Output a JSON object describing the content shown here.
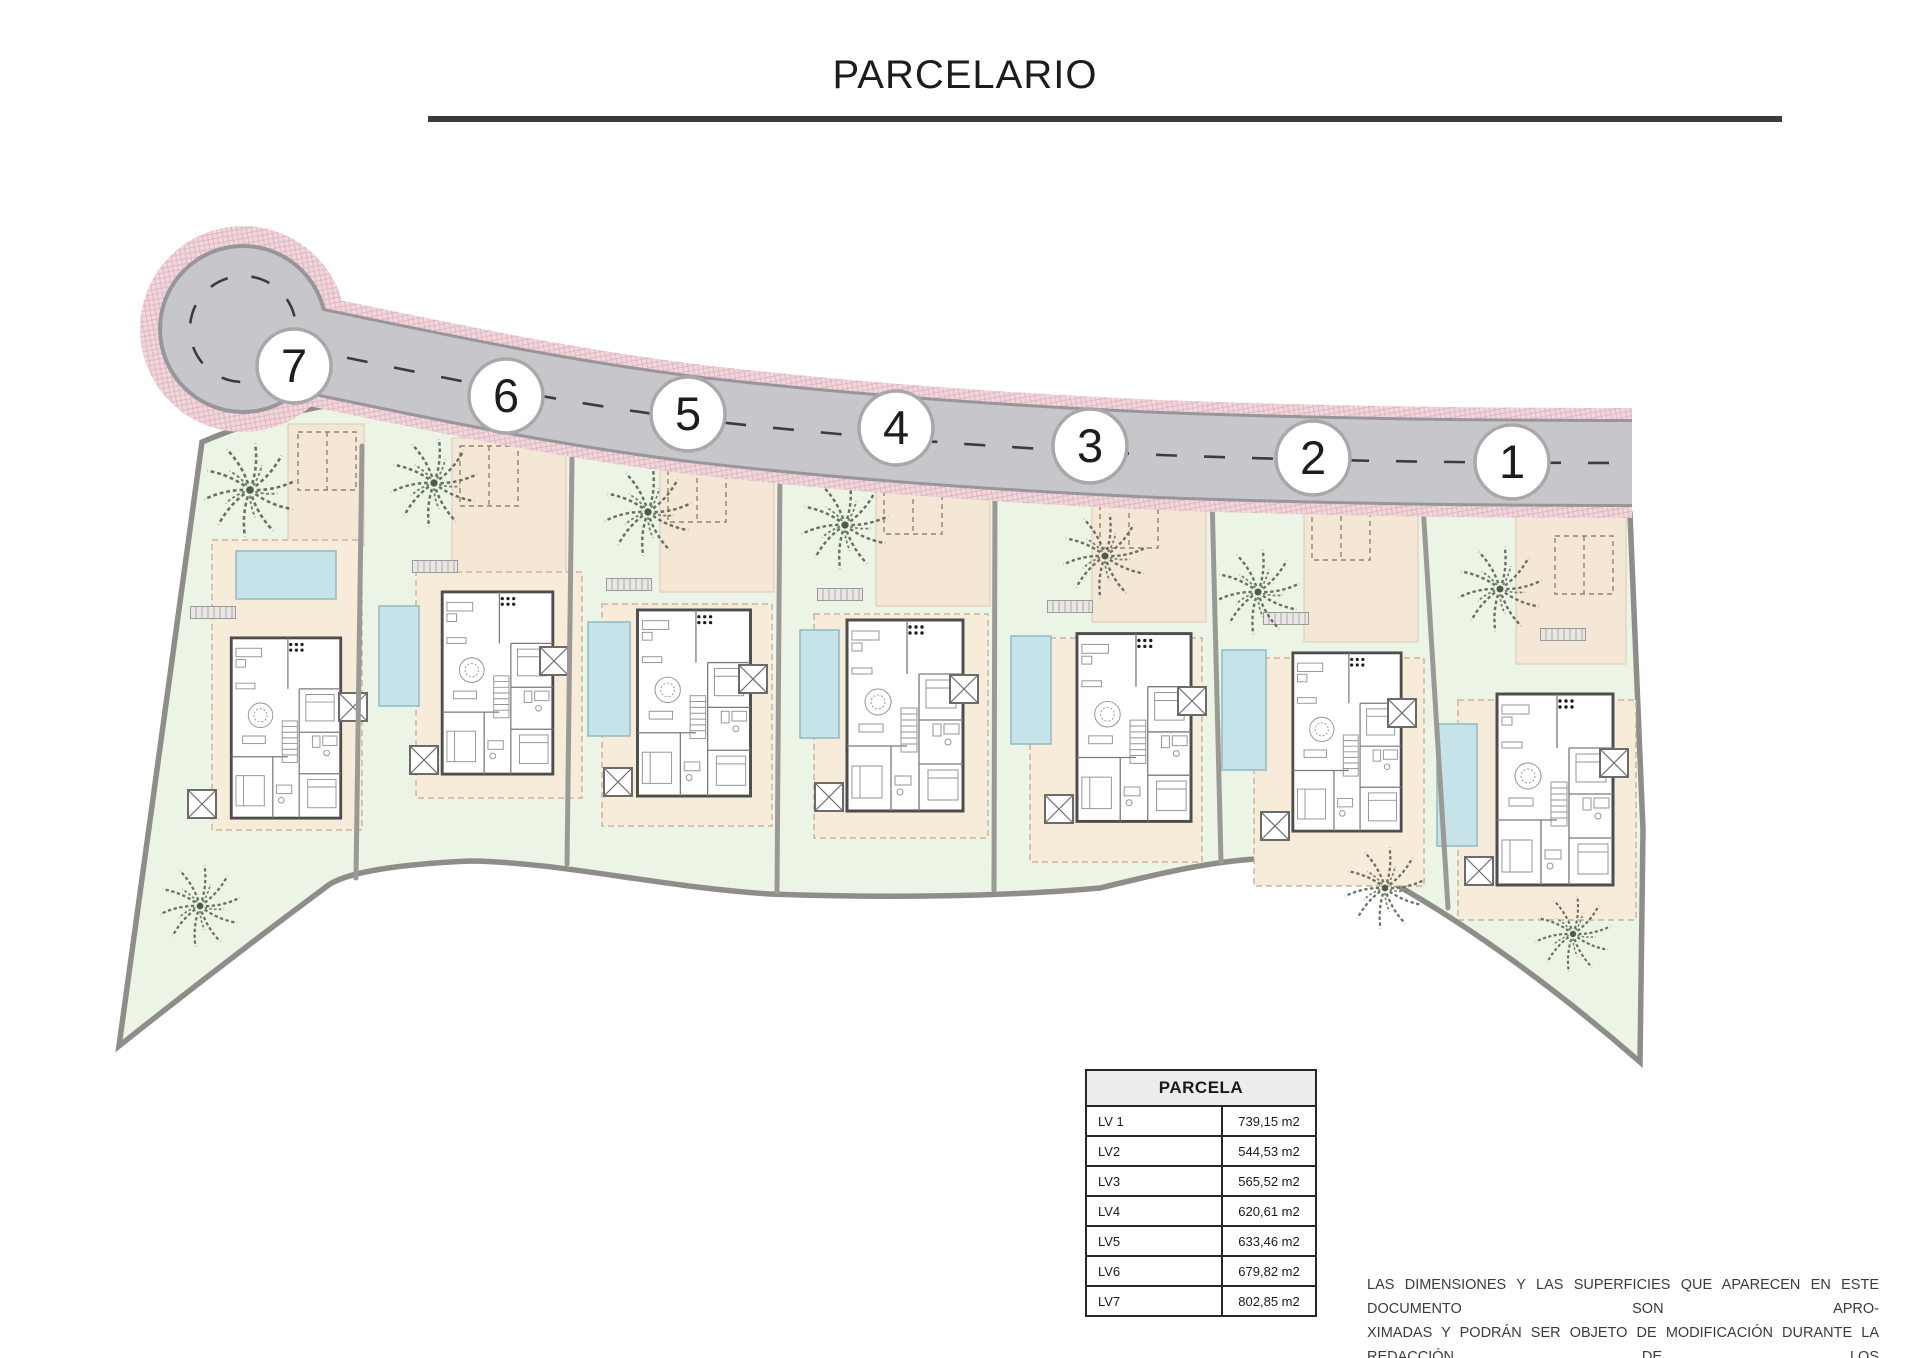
{
  "title": "PARCELARIO",
  "plan": {
    "markers": [
      {
        "label": "7"
      },
      {
        "label": "6"
      },
      {
        "label": "5"
      },
      {
        "label": "4"
      },
      {
        "label": "3"
      },
      {
        "label": "2"
      },
      {
        "label": "1"
      }
    ]
  },
  "table": {
    "header": "PARCELA",
    "rows": [
      {
        "name": "LV 1",
        "area": "739,15 m2"
      },
      {
        "name": "LV2",
        "area": "544,53 m2"
      },
      {
        "name": "LV3",
        "area": "565,52 m2"
      },
      {
        "name": "LV4",
        "area": "620,61 m2"
      },
      {
        "name": "LV5",
        "area": "633,46 m2"
      },
      {
        "name": "LV6",
        "area": "679,82 m2"
      },
      {
        "name": "LV7",
        "area": "802,85 m2"
      }
    ]
  },
  "disclaimer": {
    "lines": [
      "LAS DIMENSIONES Y LAS SUPERFICIES QUE APARECEN EN ESTE DOCUMENTO SON APRO-",
      "XIMADAS Y PODRÁN SER OBJETO DE MODIFICACIÓN DURANTE LA REDACCIÓN DE LOS",
      "PROYECTOS BÁSICO Y DE EJECUCIÓN"
    ]
  },
  "colors": {
    "road_asphalt": "#c7c6cb",
    "road_edge": "#98969b",
    "pink": "#f1d7dc",
    "pink_line": "#ddb5bf",
    "lawn": "#ecf4e6",
    "boundary": "#8f8d89",
    "terrace": "#f7ebda",
    "driveway": "#f4e7d6",
    "pool": "#c5e3e9",
    "pool_edge": "#96bcc4",
    "marker_border": "#a9a7a7",
    "centerline": "#3c3c3c",
    "text_dark": "#1c1c1c"
  }
}
